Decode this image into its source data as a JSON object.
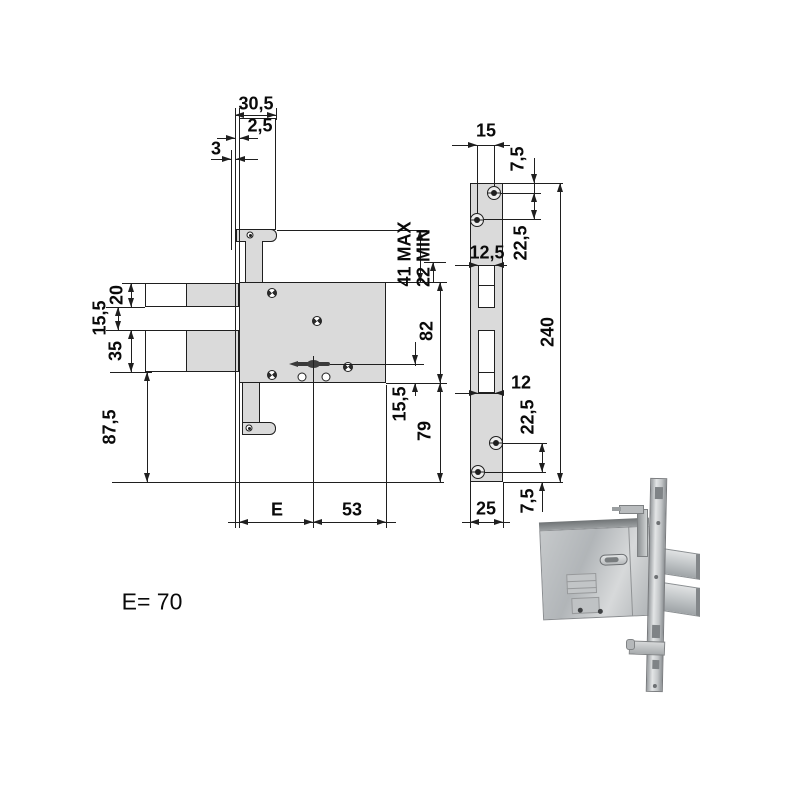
{
  "drawing": {
    "front_view": {
      "dims": {
        "top_width": "30,5",
        "faceplate_thickness": "2,5",
        "faceplate_offset": "3",
        "cylinder_max": "41 MAX",
        "cylinder_min": "22 MIN",
        "top_bolt_height": "20",
        "bolt_gap": "15,5",
        "bottom_bolt_height": "35",
        "below_body": "87,5",
        "body_height": "82",
        "key_to_bottom": "15,5",
        "body_to_baseline": "79",
        "backset_label": "E",
        "key_to_rear": "53"
      }
    },
    "faceplate_view": {
      "dims": {
        "screw_spacing_h": "15",
        "top_edge_to_screw": "7,5",
        "top_screw_spacing": "22,5",
        "top_cutout_width": "12,5",
        "faceplate_length": "240",
        "bottom_cutout_width": "12",
        "bottom_screw_spacing": "22,5",
        "bottom_screw_to_edge": "7,5",
        "faceplate_width": "25"
      }
    },
    "note": "E= 70",
    "colors": {
      "line": "#1f1f1f",
      "fill": "#dadada",
      "background": "#ffffff"
    }
  }
}
